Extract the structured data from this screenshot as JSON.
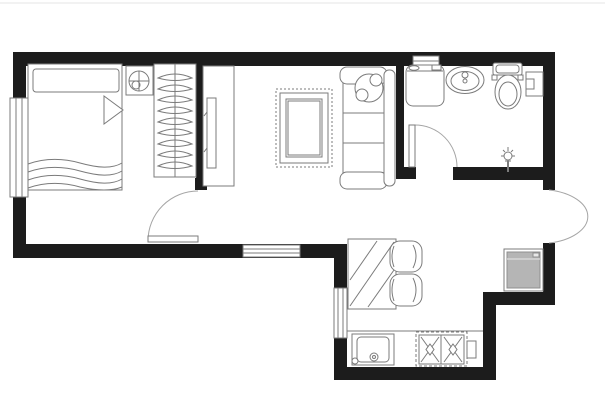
{
  "meta": {
    "type": "architectural-floor-plan",
    "description": "Top-down one-bedroom apartment floor plan, black walls, gray furniture line work, no text labels"
  },
  "canvas": {
    "width": 605,
    "height": 400,
    "background": "#ffffff",
    "frame_line_color": "#e4e4e4"
  },
  "colors": {
    "wall": "#1c1c1c",
    "line": "#7b7b7b",
    "door": "#a5a5a5",
    "white": "#ffffff",
    "appliance_fill": "#b5b5b5",
    "appliance_light": "#e8e8e8"
  },
  "rooms": [
    {
      "name": "room-bedroom",
      "bounds": [
        26,
        66,
        170,
        178
      ]
    },
    {
      "name": "room-living",
      "bounds": [
        204,
        66,
        192,
        178
      ]
    },
    {
      "name": "room-bathroom",
      "bounds": [
        404,
        66,
        139,
        101
      ]
    },
    {
      "name": "room-entry-hall",
      "bounds": [
        404,
        180,
        139,
        64
      ]
    },
    {
      "name": "room-kitchen",
      "bounds": [
        347,
        244,
        136,
        123
      ]
    },
    {
      "name": "room-fridge-alcove",
      "bounds": [
        496,
        243,
        47,
        49
      ]
    }
  ],
  "walls": [
    {
      "name": "wall-top",
      "r": [
        13,
        52,
        542,
        14
      ]
    },
    {
      "name": "wall-left",
      "r": [
        13,
        52,
        13,
        206
      ]
    },
    {
      "name": "wall-bottom-left",
      "r": [
        13,
        244,
        332,
        14
      ]
    },
    {
      "name": "wall-right-upper",
      "r": [
        543,
        52,
        12,
        138
      ]
    },
    {
      "name": "wall-right-alcove",
      "r": [
        543,
        243,
        12,
        62
      ]
    },
    {
      "name": "wall-alcove-bottom",
      "r": [
        483,
        292,
        72,
        13
      ]
    },
    {
      "name": "wall-kitchen-right",
      "r": [
        483,
        292,
        13,
        88
      ]
    },
    {
      "name": "wall-kitchen-bottom",
      "r": [
        334,
        367,
        162,
        13
      ]
    },
    {
      "name": "wall-kitchen-left",
      "r": [
        334,
        244,
        13,
        136
      ]
    },
    {
      "name": "wall-bedroom-partition",
      "r": [
        196,
        52,
        8,
        138
      ]
    },
    {
      "name": "wall-partition-jamb",
      "r": [
        195,
        178,
        12,
        12
      ]
    },
    {
      "name": "wall-bath-partition",
      "r": [
        396,
        52,
        8,
        121
      ]
    },
    {
      "name": "wall-bath-door-stub",
      "r": [
        396,
        167,
        20,
        12
      ]
    },
    {
      "name": "wall-bath-bottom",
      "r": [
        453,
        167,
        90,
        13
      ]
    }
  ],
  "windows": [
    {
      "name": "window-bedroom",
      "rect": [
        10,
        98,
        18,
        99
      ],
      "lines": [
        [
          16,
          98,
          16,
          197
        ],
        [
          22,
          98,
          22,
          197
        ]
      ]
    },
    {
      "name": "window-living",
      "rect": [
        243,
        245,
        57,
        12
      ],
      "lines": [
        [
          243,
          249,
          300,
          249
        ],
        [
          243,
          253,
          300,
          253
        ]
      ]
    },
    {
      "name": "window-kitchen",
      "rect": [
        334,
        288,
        13,
        50
      ],
      "lines": [
        [
          338,
          288,
          338,
          338
        ],
        [
          343,
          288,
          343,
          338
        ]
      ]
    },
    {
      "name": "window-bathroom",
      "rect": [
        413,
        56,
        26,
        10
      ],
      "lines": [
        [
          413,
          61,
          439,
          61
        ]
      ]
    }
  ],
  "doors": [
    {
      "name": "door-bedroom",
      "leaf": [
        148,
        236,
        50,
        6
      ],
      "arc": "M198,191 A50,50 0 0 0 148,241"
    },
    {
      "name": "door-bathroom",
      "leaf": [
        409,
        125,
        6,
        42
      ],
      "arc": "M415,125 A42,42 0 0 1 457,167"
    },
    {
      "name": "door-entrance",
      "leaf": null,
      "arc": "M549,190 A48,27 0 0 1 549,243"
    }
  ],
  "furniture": [
    {
      "name": "bed",
      "shapes": [
        {
          "t": "rect",
          "a": [
            28,
            64,
            94,
            126
          ]
        },
        {
          "t": "rect",
          "a": [
            33,
            69,
            86,
            23
          ],
          "rx": 3
        },
        {
          "t": "polygon",
          "pts": "104,96 123,110 104,124"
        },
        {
          "t": "path",
          "d": "M28,164 C45,158 62,158 80,163 C98,168 112,169 122,163"
        },
        {
          "t": "path",
          "d": "M28,172 C45,166 62,166 80,171 C98,176 112,177 122,171"
        },
        {
          "t": "path",
          "d": "M28,180 C45,174 62,174 80,179 C98,184 112,185 122,179"
        },
        {
          "t": "path",
          "d": "M28,188 C45,182 62,182 80,187 C98,191 112,191 122,187"
        }
      ]
    },
    {
      "name": "nightstand-lamp",
      "shapes": [
        {
          "t": "rect",
          "a": [
            126,
            66,
            27,
            29
          ]
        },
        {
          "t": "circle",
          "a": [
            139,
            81,
            10
          ]
        },
        {
          "t": "line",
          "a": [
            129,
            81,
            149,
            81
          ]
        },
        {
          "t": "line",
          "a": [
            139,
            71,
            139,
            91
          ]
        },
        {
          "t": "circle",
          "a": [
            136,
            85,
            4
          ],
          "fill": "none"
        }
      ]
    },
    {
      "name": "wardrobe",
      "shapes": [
        {
          "t": "rect",
          "a": [
            154,
            64,
            42,
            113
          ]
        },
        {
          "t": "line",
          "a": [
            175,
            64,
            175,
            177
          ]
        },
        {
          "t": "path",
          "d": "M158,78 Q175,70 192,78 Q175,83 158,78 Z"
        },
        {
          "t": "path",
          "d": "M158,89 Q175,81 192,89 Q175,94 158,89 Z"
        },
        {
          "t": "path",
          "d": "M158,100 Q175,92 192,100 Q175,105 158,100 Z"
        },
        {
          "t": "path",
          "d": "M158,111 Q175,103 192,111 Q175,116 158,111 Z"
        },
        {
          "t": "path",
          "d": "M158,122 Q175,114 192,122 Q175,127 158,122 Z"
        },
        {
          "t": "path",
          "d": "M158,133 Q175,125 192,133 Q175,138 158,133 Z"
        },
        {
          "t": "path",
          "d": "M158,144 Q175,136 192,144 Q175,149 158,144 Z"
        },
        {
          "t": "path",
          "d": "M158,155 Q175,147 192,155 Q175,160 158,155 Z"
        },
        {
          "t": "path",
          "d": "M158,166 Q175,158 192,166 Q175,171 158,166 Z"
        }
      ]
    },
    {
      "name": "tv-cabinet",
      "shapes": [
        {
          "t": "rect",
          "a": [
            203,
            66,
            31,
            120
          ]
        },
        {
          "t": "rect",
          "a": [
            207,
            98,
            9,
            70
          ]
        },
        {
          "t": "line",
          "a": [
            204,
            116,
            207,
            112
          ]
        },
        {
          "t": "line",
          "a": [
            204,
            152,
            207,
            148
          ]
        }
      ]
    },
    {
      "name": "rug",
      "shapes": [
        {
          "t": "rect",
          "a": [
            276,
            89,
            56,
            78
          ],
          "dash": "2 2"
        },
        {
          "t": "rect",
          "a": [
            280,
            93,
            48,
            70
          ]
        },
        {
          "t": "rect",
          "a": [
            286,
            99,
            36,
            58
          ]
        },
        {
          "t": "rect",
          "a": [
            288,
            101,
            32,
            54
          ]
        }
      ]
    },
    {
      "name": "sofa",
      "shapes": [
        {
          "t": "rect",
          "a": [
            343,
            83,
            42,
            90
          ]
        },
        {
          "t": "line",
          "a": [
            343,
            113,
            385,
            113
          ]
        },
        {
          "t": "line",
          "a": [
            343,
            143,
            385,
            143
          ]
        },
        {
          "t": "rect",
          "a": [
            340,
            67,
            47,
            17
          ],
          "rx": 7
        },
        {
          "t": "rect",
          "a": [
            340,
            172,
            47,
            17
          ],
          "rx": 7
        },
        {
          "t": "rect",
          "a": [
            384,
            70,
            11,
            116
          ],
          "rx": 5
        }
      ]
    },
    {
      "name": "plant",
      "shapes": [
        {
          "t": "circle",
          "a": [
            369,
            88,
            14
          ]
        },
        {
          "t": "circle",
          "a": [
            362,
            95,
            6
          ]
        },
        {
          "t": "circle",
          "a": [
            376,
            80,
            6
          ]
        }
      ]
    },
    {
      "name": "dining-table",
      "shapes": [
        {
          "t": "rect",
          "a": [
            348,
            239,
            48,
            70
          ]
        },
        {
          "t": "line",
          "a": [
            350,
            306,
            394,
            242
          ]
        },
        {
          "t": "line",
          "a": [
            350,
            280,
            377,
            241
          ]
        },
        {
          "t": "line",
          "a": [
            368,
            307,
            394,
            270
          ]
        }
      ]
    },
    {
      "name": "dining-chairs",
      "shapes": [
        {
          "t": "rect",
          "a": [
            390,
            241,
            32,
            31
          ],
          "rx": 10
        },
        {
          "t": "path",
          "d": "M413,245 Q419,256 413,268"
        },
        {
          "t": "path",
          "d": "M394,246 Q390,256 394,267"
        },
        {
          "t": "rect",
          "a": [
            390,
            274,
            32,
            32
          ],
          "rx": 10
        },
        {
          "t": "path",
          "d": "M413,278 Q419,290 413,302"
        },
        {
          "t": "path",
          "d": "M394,279 Q390,290 394,301"
        }
      ]
    },
    {
      "name": "kitchen-counter",
      "shapes": [
        {
          "t": "line",
          "a": [
            347,
            331,
            483,
            331
          ]
        }
      ]
    },
    {
      "name": "kitchen-sink",
      "shapes": [
        {
          "t": "rect",
          "a": [
            352,
            334,
            42,
            31
          ]
        },
        {
          "t": "rect",
          "a": [
            357,
            337,
            32,
            25
          ],
          "rx": 4
        },
        {
          "t": "circle",
          "a": [
            355,
            361,
            3
          ],
          "fill": "none"
        },
        {
          "t": "circle",
          "a": [
            374,
            357,
            4
          ],
          "fill": "none"
        },
        {
          "t": "circle",
          "a": [
            374,
            357,
            1.5
          ],
          "fill": "none"
        }
      ]
    },
    {
      "name": "stove",
      "shapes": [
        {
          "t": "rect",
          "a": [
            416,
            332,
            51,
            34
          ],
          "dash": "3 2"
        },
        {
          "t": "rect",
          "a": [
            419,
            335,
            45,
            29
          ]
        },
        {
          "t": "line",
          "a": [
            441,
            335,
            441,
            364
          ]
        },
        {
          "t": "line",
          "a": [
            421,
            337,
            439,
            362
          ]
        },
        {
          "t": "line",
          "a": [
            439,
            337,
            421,
            362
          ]
        },
        {
          "t": "line",
          "a": [
            444,
            337,
            462,
            362
          ]
        },
        {
          "t": "line",
          "a": [
            462,
            337,
            444,
            362
          ]
        },
        {
          "t": "polygon",
          "pts": "430,344 434,349.5 430,355 426,349.5"
        },
        {
          "t": "polygon",
          "pts": "453,344 457,349.5 453,355 449,349.5"
        },
        {
          "t": "rect",
          "a": [
            467,
            341,
            9,
            17
          ]
        }
      ]
    },
    {
      "name": "refrigerator",
      "shapes": [
        {
          "t": "rect",
          "a": [
            504,
            249,
            39,
            42
          ]
        },
        {
          "t": "rect",
          "a": [
            507,
            252,
            33,
            36
          ],
          "fill": "#b5b5b5",
          "stroke": "#8f8f8f"
        },
        {
          "t": "line",
          "a": [
            507,
            259,
            540,
            259
          ],
          "stroke": "#e8e8e8"
        },
        {
          "t": "rect",
          "a": [
            533,
            253,
            6,
            4
          ],
          "fill": "#e8e8e8",
          "stroke": "#8f8f8f"
        }
      ]
    },
    {
      "name": "washing-machine",
      "shapes": [
        {
          "t": "rect",
          "a": [
            406,
            65,
            38,
            41
          ],
          "rx": 7
        },
        {
          "t": "line",
          "a": [
            407,
            71,
            443,
            71
          ]
        },
        {
          "t": "ellipse",
          "a": [
            414,
            68,
            5,
            2.2
          ],
          "fill": "none"
        },
        {
          "t": "rect",
          "a": [
            432,
            65,
            9,
            5
          ]
        }
      ]
    },
    {
      "name": "bathroom-sink",
      "shapes": [
        {
          "t": "ellipse",
          "a": [
            465,
            80,
            19,
            13.5
          ]
        },
        {
          "t": "ellipse",
          "a": [
            465,
            81,
            14,
            9.5
          ],
          "fill": "none"
        },
        {
          "t": "circle",
          "a": [
            465,
            75,
            3
          ],
          "fill": "none"
        },
        {
          "t": "circle",
          "a": [
            465,
            81,
            2
          ],
          "fill": "none"
        }
      ]
    },
    {
      "name": "toilet",
      "shapes": [
        {
          "t": "ellipse",
          "a": [
            508,
            92,
            13,
            17
          ]
        },
        {
          "t": "ellipse",
          "a": [
            508,
            94,
            9,
            12
          ],
          "fill": "none"
        },
        {
          "t": "rect",
          "a": [
            493,
            63,
            29,
            12
          ],
          "rx": 2
        },
        {
          "t": "rect",
          "a": [
            496,
            65,
            23,
            8
          ],
          "rx": 3,
          "fill": "none"
        },
        {
          "t": "rect",
          "a": [
            492,
            75,
            5,
            5
          ]
        },
        {
          "t": "rect",
          "a": [
            518,
            75,
            5,
            5
          ]
        }
      ]
    },
    {
      "name": "bath-cabinet",
      "shapes": [
        {
          "t": "rect",
          "a": [
            526,
            72,
            17,
            24
          ]
        },
        {
          "t": "rect",
          "a": [
            526,
            79,
            8,
            10
          ]
        }
      ]
    },
    {
      "name": "floor-drain",
      "shapes": [
        {
          "t": "circle",
          "a": [
            508,
            156,
            4
          ],
          "fill": "none"
        },
        {
          "t": "line",
          "a": [
            508,
            147,
            508,
            151
          ]
        },
        {
          "t": "line",
          "a": [
            503,
            150,
            505,
            152
          ]
        },
        {
          "t": "line",
          "a": [
            513,
            150,
            511,
            152
          ]
        },
        {
          "t": "line",
          "a": [
            501,
            156,
            504,
            156
          ]
        },
        {
          "t": "line",
          "a": [
            515,
            156,
            512,
            156
          ]
        },
        {
          "t": "line",
          "a": [
            505,
            161,
            511,
            161
          ]
        },
        {
          "t": "line",
          "a": [
            508,
            161,
            508,
            172
          ],
          "sw": 2
        }
      ]
    }
  ]
}
